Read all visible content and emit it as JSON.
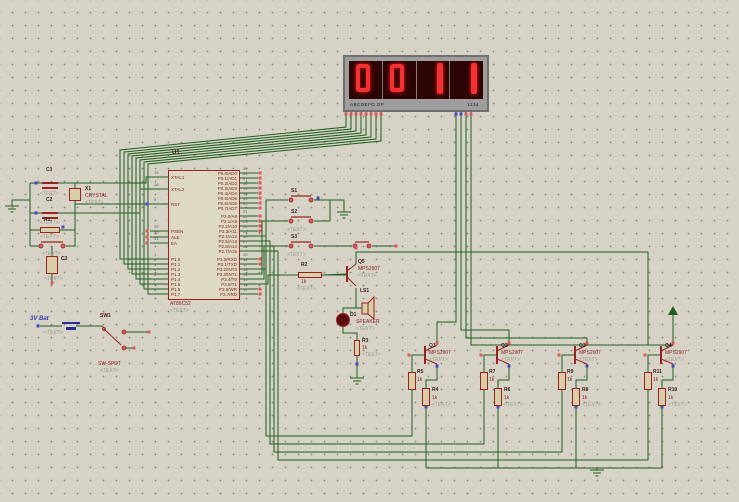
{
  "display": {
    "digits": [
      "0",
      "0",
      "1",
      "1"
    ],
    "seg_label": "ABCDEFG DP",
    "digit_label": "1234"
  },
  "mcu": {
    "ref": "U1",
    "value": "AT89C52",
    "placeholder": "<TEXT>",
    "left_pins": [
      {
        "num": "19",
        "name": "XTAL1"
      },
      {
        "num": "18",
        "name": "XTAL2"
      },
      {
        "num": "9",
        "name": "RST"
      },
      {
        "num": "29",
        "name": "PSEN"
      },
      {
        "num": "30",
        "name": "ALE"
      },
      {
        "num": "31",
        "name": "EA"
      },
      {
        "num": "1",
        "name": "P1.0"
      },
      {
        "num": "2",
        "name": "P1.1"
      },
      {
        "num": "3",
        "name": "P1.2"
      },
      {
        "num": "4",
        "name": "P1.3"
      },
      {
        "num": "5",
        "name": "P1.4"
      },
      {
        "num": "6",
        "name": "P1.5"
      },
      {
        "num": "7",
        "name": "P1.6"
      },
      {
        "num": "8",
        "name": "P1.7"
      }
    ],
    "right_pins": [
      {
        "num": "39",
        "name": "P0.0/AD0"
      },
      {
        "num": "38",
        "name": "P0.1/AD1"
      },
      {
        "num": "37",
        "name": "P0.2/AD2"
      },
      {
        "num": "36",
        "name": "P0.3/AD3"
      },
      {
        "num": "35",
        "name": "P0.4/AD4"
      },
      {
        "num": "34",
        "name": "P0.5/AD5"
      },
      {
        "num": "33",
        "name": "P0.6/AD6"
      },
      {
        "num": "32",
        "name": "P0.7/AD7"
      },
      {
        "num": "21",
        "name": "P2.0/A8"
      },
      {
        "num": "22",
        "name": "P2.1/A9"
      },
      {
        "num": "23",
        "name": "P2.2/A10"
      },
      {
        "num": "24",
        "name": "P2.3/A11"
      },
      {
        "num": "25",
        "name": "P2.4/A12"
      },
      {
        "num": "26",
        "name": "P2.5/A13"
      },
      {
        "num": "27",
        "name": "P2.6/A14"
      },
      {
        "num": "28",
        "name": "P2.7/A15"
      },
      {
        "num": "10",
        "name": "P3.0/RXD"
      },
      {
        "num": "11",
        "name": "P3.1/TXD"
      },
      {
        "num": "12",
        "name": "P3.2/INT0"
      },
      {
        "num": "13",
        "name": "P3.3/INT1"
      },
      {
        "num": "14",
        "name": "P3.4/T0"
      },
      {
        "num": "15",
        "name": "P3.5/T1"
      },
      {
        "num": "16",
        "name": "P3.6/WR"
      },
      {
        "num": "17",
        "name": "P3.7/RD"
      }
    ]
  },
  "parts": {
    "c1": {
      "ref": "C1",
      "ph": "<TEXT>"
    },
    "c2": {
      "ref": "C2",
      "ph": "<TEXT>"
    },
    "x1": {
      "ref": "X1",
      "value": "CRYSTAL",
      "ph": "<TEXT>"
    },
    "r1": {
      "ref": "R1",
      "ph": "<TEXT>"
    },
    "reset_btn": {
      "ph": "<TEXT>"
    },
    "c3": {
      "ref": "C3",
      "ph": "<TEXT>"
    },
    "s1": {
      "ref": "S1"
    },
    "s2": {
      "ref": "S2",
      "ph": "<TEXT>"
    },
    "s3": {
      "ref": "S3",
      "ph": "<TEXT>"
    },
    "r2": {
      "ref": "R2",
      "value": "1k",
      "ph": "<TEXT>"
    },
    "q5": {
      "ref": "Q5",
      "value": "MPS2907",
      "ph": "<TEXT>"
    },
    "ls1": {
      "ref": "LS1",
      "value": "SPEAKER",
      "ph": "<TEXT>"
    },
    "d1": {
      "ref": "D1"
    },
    "r3": {
      "ref": "R3",
      "value": "1k",
      "ph": "<TEXT>"
    },
    "battery": {
      "label": "3V Bat",
      "ph": "<TEXT>"
    },
    "sw1": {
      "ref": "SW1",
      "value": "SW-SPDT",
      "ph": "<TEXT>"
    }
  },
  "groups": [
    {
      "q_ref": "Q1",
      "q_value": "MPS2907",
      "rb_ref": "R5",
      "rb_value": "1k",
      "rc_ref": "R4",
      "rc_value": "1k",
      "ph": "<TEXT>"
    },
    {
      "q_ref": "Q2",
      "q_value": "MPS2907",
      "rb_ref": "R7",
      "rb_value": "1k",
      "rc_ref": "R6",
      "rc_value": "1k",
      "ph": "<TEXT>"
    },
    {
      "q_ref": "Q3",
      "q_value": "MPS2907",
      "rb_ref": "R9",
      "rb_value": "1k",
      "rc_ref": "R8",
      "rc_value": "1k",
      "ph": "<TEXT>"
    },
    {
      "q_ref": "Q4",
      "q_value": "MPS2907",
      "rb_ref": "R11",
      "rb_value": "1k",
      "rc_ref": "R10",
      "rc_value": "1k",
      "ph": "<TEXT>"
    }
  ]
}
